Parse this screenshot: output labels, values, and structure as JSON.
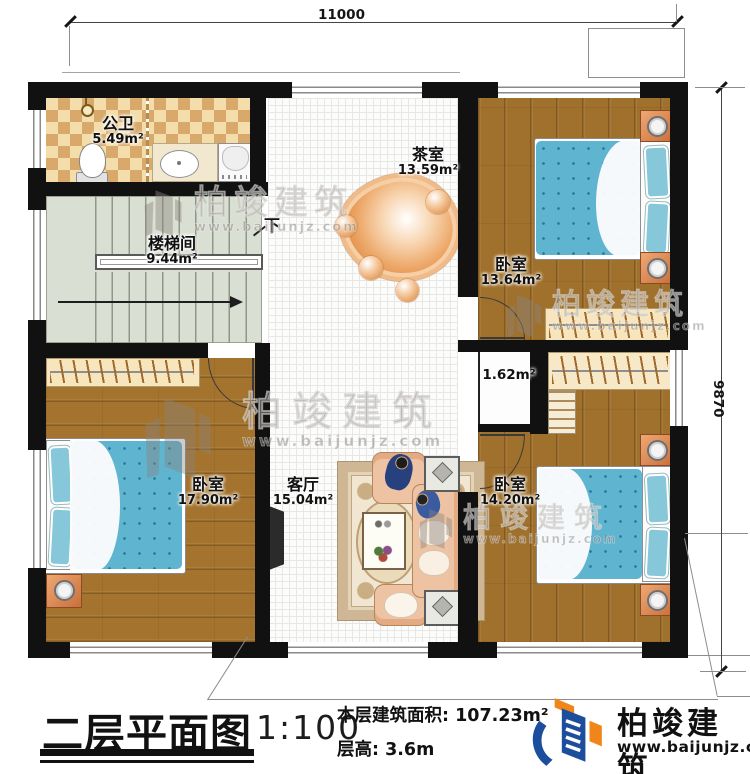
{
  "dimensions": {
    "top": "11000",
    "right": "9870"
  },
  "rooms": {
    "bathroom": {
      "name": "公卫",
      "area": "5.49m²"
    },
    "stairwell": {
      "name": "楼梯间",
      "area": "9.44m²"
    },
    "tea_room": {
      "name": "茶室",
      "area": "13.59m²"
    },
    "bedroom_top_right": {
      "name": "卧室",
      "area": "13.64m²"
    },
    "hall_nook": {
      "area": "1.62m²"
    },
    "bedroom_bottom_left": {
      "name": "卧室",
      "area": "17.90m²"
    },
    "living_room": {
      "name": "客厅",
      "area": "15.04m²"
    },
    "bedroom_bottom_right": {
      "name": "卧室",
      "area": "14.20m²"
    }
  },
  "stairs": {
    "down_label": "下"
  },
  "title_block": {
    "title": "二层平面图",
    "scale": "1:100",
    "area_line": "本层建筑面积: 107.23m²",
    "height_line": "层高: 3.6m"
  },
  "brand": {
    "name": "柏竣建筑",
    "website": "www.baijunjz.com"
  },
  "watermark": {
    "name": "柏竣建筑",
    "website": "www.baijunjz.com"
  },
  "colors": {
    "wall": "#111111",
    "wood": "#a0712c",
    "tile_dark": "#d9a96b",
    "tile_light": "#f3ddab",
    "stair_floor": "#dadfd3",
    "bed_blue": "#5fb4cf",
    "nightstand_orange": "#e08a4f",
    "logo_blue": "#1c4e9d",
    "logo_orange": "#f08519"
  }
}
